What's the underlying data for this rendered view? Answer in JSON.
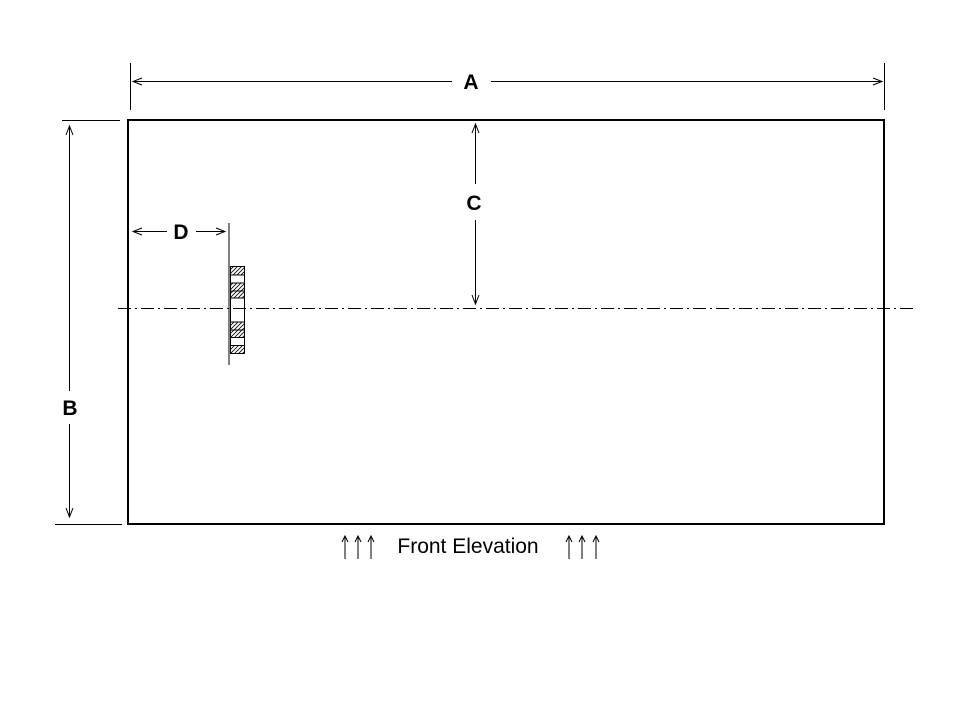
{
  "drawing": {
    "background_color": "#ffffff",
    "line_color": "#000000",
    "caption": "Front Elevation",
    "dimensions": {
      "a": "A",
      "b": "B",
      "c": "C",
      "d": "D"
    },
    "icons": {
      "dimension_arrow": "open-arrowhead",
      "up_arrow": "↑"
    }
  }
}
